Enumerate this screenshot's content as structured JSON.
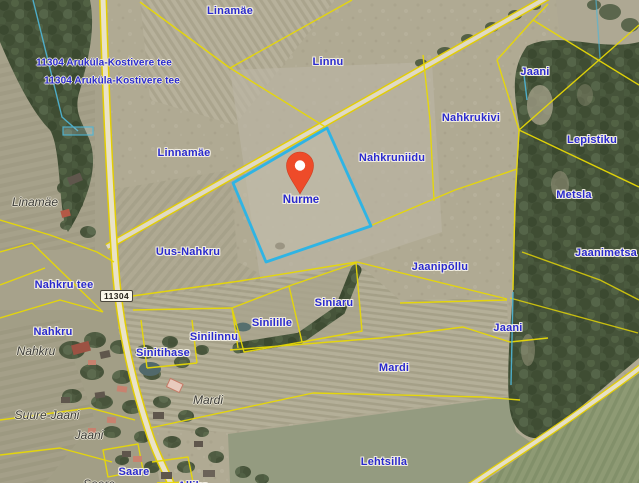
{
  "map": {
    "marker": {
      "label": "Nurme",
      "color": "#ee4b29"
    },
    "selected_parcel": {
      "name": "Nurme",
      "outline_color": "#2fb4e4"
    },
    "road_shield": {
      "number": "11304"
    },
    "colors": {
      "parcel_line": "#e7d806",
      "label_blue": "#2a2ace",
      "selected_outline": "#2fb4e4",
      "marker": "#ee4b29"
    },
    "labels": {
      "parcel": [
        {
          "text": "Linamäe",
          "x": 230,
          "y": 11
        },
        {
          "text": "Linnu",
          "x": 328,
          "y": 62
        },
        {
          "text": "Jaani",
          "x": 535,
          "y": 72
        },
        {
          "text": "Nahkrukivi",
          "x": 471,
          "y": 118
        },
        {
          "text": "Lepistiku",
          "x": 592,
          "y": 140
        },
        {
          "text": "Linnamäe",
          "x": 184,
          "y": 153
        },
        {
          "text": "Nahkruniidu",
          "x": 392,
          "y": 158
        },
        {
          "text": "Metsla",
          "x": 574,
          "y": 195
        },
        {
          "text": "Uus-Nahkru",
          "x": 188,
          "y": 252
        },
        {
          "text": "Jaanimetsa",
          "x": 606,
          "y": 253
        },
        {
          "text": "Jaanipõllu",
          "x": 440,
          "y": 267
        },
        {
          "text": "Nahkru tee",
          "x": 64,
          "y": 285
        },
        {
          "text": "Siniaru",
          "x": 334,
          "y": 303
        },
        {
          "text": "Sinilille",
          "x": 272,
          "y": 323
        },
        {
          "text": "Nahkru",
          "x": 53,
          "y": 332
        },
        {
          "text": "Sinilinnu",
          "x": 214,
          "y": 337
        },
        {
          "text": "Jaani",
          "x": 508,
          "y": 328
        },
        {
          "text": "Sinitihase",
          "x": 163,
          "y": 353
        },
        {
          "text": "Mardi",
          "x": 394,
          "y": 368
        },
        {
          "text": "Lehtsilla",
          "x": 384,
          "y": 462
        },
        {
          "text": "Saare",
          "x": 134,
          "y": 472
        },
        {
          "text": "Allika",
          "x": 193,
          "y": 486
        }
      ],
      "village": [
        {
          "text": "Linamäe",
          "x": 35,
          "y": 202
        },
        {
          "text": "Nahkru",
          "x": 36,
          "y": 351
        },
        {
          "text": "Suure-Jaani",
          "x": 47,
          "y": 415
        },
        {
          "text": "Jaani",
          "x": 89,
          "y": 435
        },
        {
          "text": "Mardi",
          "x": 208,
          "y": 400
        },
        {
          "text": "Saare",
          "x": 99,
          "y": 484
        }
      ],
      "road": [
        {
          "text": "11304 Aruküla-Kostivere tee",
          "x": 104,
          "y": 63
        },
        {
          "text": "11304 Aruküla-Kostivere tee",
          "x": 112,
          "y": 81
        }
      ]
    }
  }
}
